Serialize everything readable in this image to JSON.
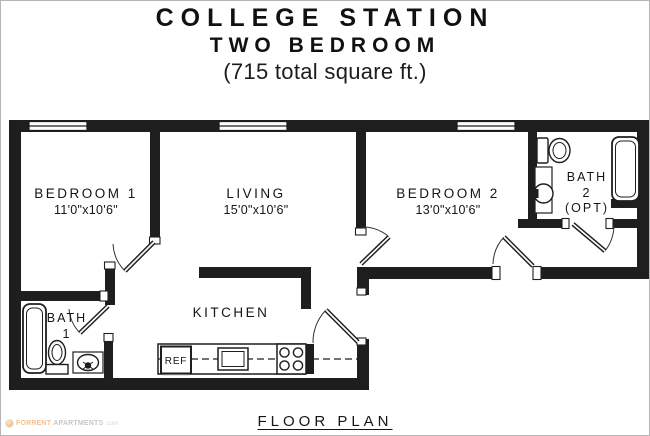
{
  "title": {
    "line1": "COLLEGE STATION",
    "line2": "TWO BEDROOM",
    "line3": "(715 total square ft.)"
  },
  "rooms": {
    "bedroom1": {
      "name": "BEDROOM 1",
      "dims": "11'0\"x10'6\""
    },
    "living": {
      "name": "LIVING",
      "dims": "15'0\"x10'6\""
    },
    "bedroom2": {
      "name": "BEDROOM 2",
      "dims": "13'0\"x10'6\""
    },
    "bath1": {
      "name": "BATH",
      "number": "1"
    },
    "bath2": {
      "name": "BATH",
      "number": "2",
      "note": "(OPT)"
    },
    "kitchen": {
      "name": "KITCHEN"
    }
  },
  "labels": {
    "refrigerator": "REF",
    "caption": "FLOOR PLAN"
  },
  "watermark": {
    "prefix": "FORRENT",
    "main": "APARTMENTS",
    "suffix": ".com"
  },
  "colors": {
    "wall": "#1e1e1e",
    "text": "#161616"
  }
}
